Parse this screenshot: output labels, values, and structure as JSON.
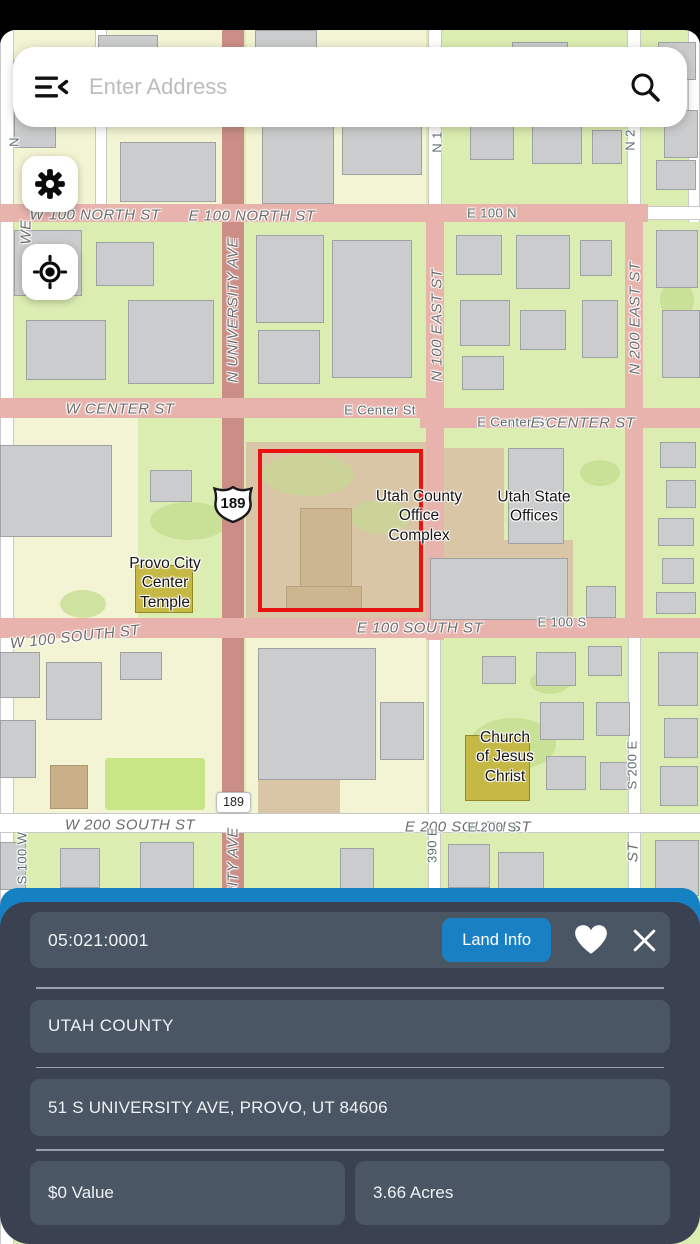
{
  "search": {
    "placeholder": "Enter Address"
  },
  "panel": {
    "parcel_id": "05:021:0001",
    "land_info_button": "Land Info",
    "county": "UTAH COUNTY",
    "address": "51 S UNIVERSITY AVE, PROVO, UT 84606",
    "value": "$0 Value",
    "acres": "3.66 Acres"
  },
  "map": {
    "us_route_shield": "189",
    "mini_route_label": "189",
    "street_labels": [
      {
        "text": "W 100 NORTH ST",
        "x": 95,
        "y": 185,
        "rot": 0,
        "kind": "major"
      },
      {
        "text": "E 100 NORTH ST",
        "x": 252,
        "y": 186,
        "rot": 0,
        "kind": "major"
      },
      {
        "text": "E 100 N",
        "x": 492,
        "y": 183,
        "rot": 0,
        "kind": "minor"
      },
      {
        "text": "N UNIVERSITY AVE",
        "x": 233,
        "y": 280,
        "rot": -90,
        "kind": "major"
      },
      {
        "text": "N 100 EAST ST",
        "x": 437,
        "y": 295,
        "rot": -90,
        "kind": "major"
      },
      {
        "text": "N 200 EAST ST",
        "x": 635,
        "y": 288,
        "rot": -90,
        "kind": "major"
      },
      {
        "text": "N 1",
        "x": 437,
        "y": 112,
        "rot": -90,
        "kind": "minor"
      },
      {
        "text": "N 2",
        "x": 630,
        "y": 110,
        "rot": -90,
        "kind": "minor"
      },
      {
        "text": "N",
        "x": 14,
        "y": 112,
        "rot": -90,
        "kind": "minor"
      },
      {
        "text": "WE",
        "x": 26,
        "y": 202,
        "rot": -90,
        "kind": "major"
      },
      {
        "text": "W CENTER ST",
        "x": 120,
        "y": 379,
        "rot": 0,
        "kind": "major"
      },
      {
        "text": "E Center St",
        "x": 380,
        "y": 380,
        "rot": 0,
        "kind": "minor"
      },
      {
        "text": "E Center St",
        "x": 513,
        "y": 392,
        "rot": 0,
        "kind": "minor"
      },
      {
        "text": "E CENTER ST",
        "x": 583,
        "y": 393,
        "rot": 0,
        "kind": "major"
      },
      {
        "text": "E 100 SOUTH ST",
        "x": 420,
        "y": 598,
        "rot": 0,
        "kind": "major"
      },
      {
        "text": "E 100 S",
        "x": 562,
        "y": 592,
        "rot": 0,
        "kind": "minor"
      },
      {
        "text": "W 100 SOUTH ST",
        "x": 75,
        "y": 607,
        "rot": -6,
        "kind": "major"
      },
      {
        "text": "W 200 SOUTH ST",
        "x": 130,
        "y": 795,
        "rot": 0,
        "kind": "major"
      },
      {
        "text": "E 200 SOUTH ST",
        "x": 468,
        "y": 797,
        "rot": 0,
        "kind": "major"
      },
      {
        "text": "E 200 S",
        "x": 492,
        "y": 797,
        "rot": 0,
        "kind": "minor"
      },
      {
        "text": "S 200 E",
        "x": 632,
        "y": 735,
        "rot": -90,
        "kind": "minor"
      },
      {
        "text": "ST",
        "x": 633,
        "y": 822,
        "rot": -90,
        "kind": "major"
      },
      {
        "text": "SITY AVE",
        "x": 233,
        "y": 832,
        "rot": -90,
        "kind": "major"
      },
      {
        "text": "390 E",
        "x": 432,
        "y": 815,
        "rot": -90,
        "kind": "minor"
      },
      {
        "text": "S 100 W",
        "x": 22,
        "y": 828,
        "rot": -90,
        "kind": "minor"
      }
    ],
    "poi_labels": [
      {
        "text": "Provo City\nCenter\nTemple",
        "x": 165,
        "y": 553
      },
      {
        "text": "Utah County\nOffice\nComplex",
        "x": 419,
        "y": 486
      },
      {
        "text": "Utah State\nOffices",
        "x": 534,
        "y": 477
      },
      {
        "text": "Church\nof Jesus\nChrist",
        "x": 505,
        "y": 727
      }
    ]
  },
  "colors": {
    "accent_blue": "#1580c2",
    "panel_bg": "#3a4150",
    "panel_card_bg": "#4b5665",
    "land_info_bg": "#1a80c4",
    "parcel_outline_red": "#e91212",
    "map_base_green": "#dcedb2",
    "road_pink": "#e7b3ac",
    "university_ave_red": "#cb8e87",
    "parcel_tan": "#d8c6a6",
    "poi_building_olive": "#c6b844"
  }
}
